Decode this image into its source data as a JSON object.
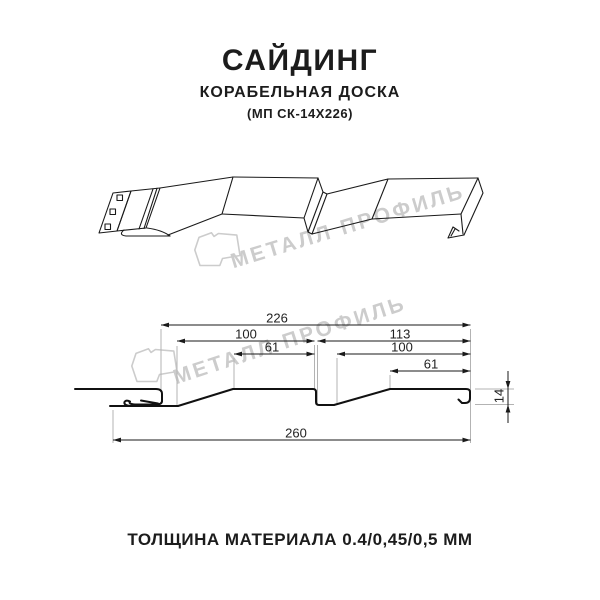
{
  "title": {
    "product": "САЙДИНГ",
    "variant": "КОРАБЕЛЬНАЯ ДОСКА",
    "model": "(МП СК-14Х226)"
  },
  "watermark": {
    "brand": "МЕТАЛЛ ПРОФИЛЬ"
  },
  "section": {
    "dims": {
      "d226": "226",
      "d100_left": "100",
      "d61_left": "61",
      "d113": "113",
      "d100_right": "100",
      "d61_right": "61",
      "d260": "260",
      "d14": "14"
    }
  },
  "footer": {
    "thickness": "ТОЛЩИНА МАТЕРИАЛА 0.4/0,45/0,5 ММ"
  },
  "colors": {
    "ink": "#1c1c1c",
    "profile_line": "#1a1a1a",
    "extension_line": "#b3b3b3",
    "watermark": "#cccccc"
  }
}
